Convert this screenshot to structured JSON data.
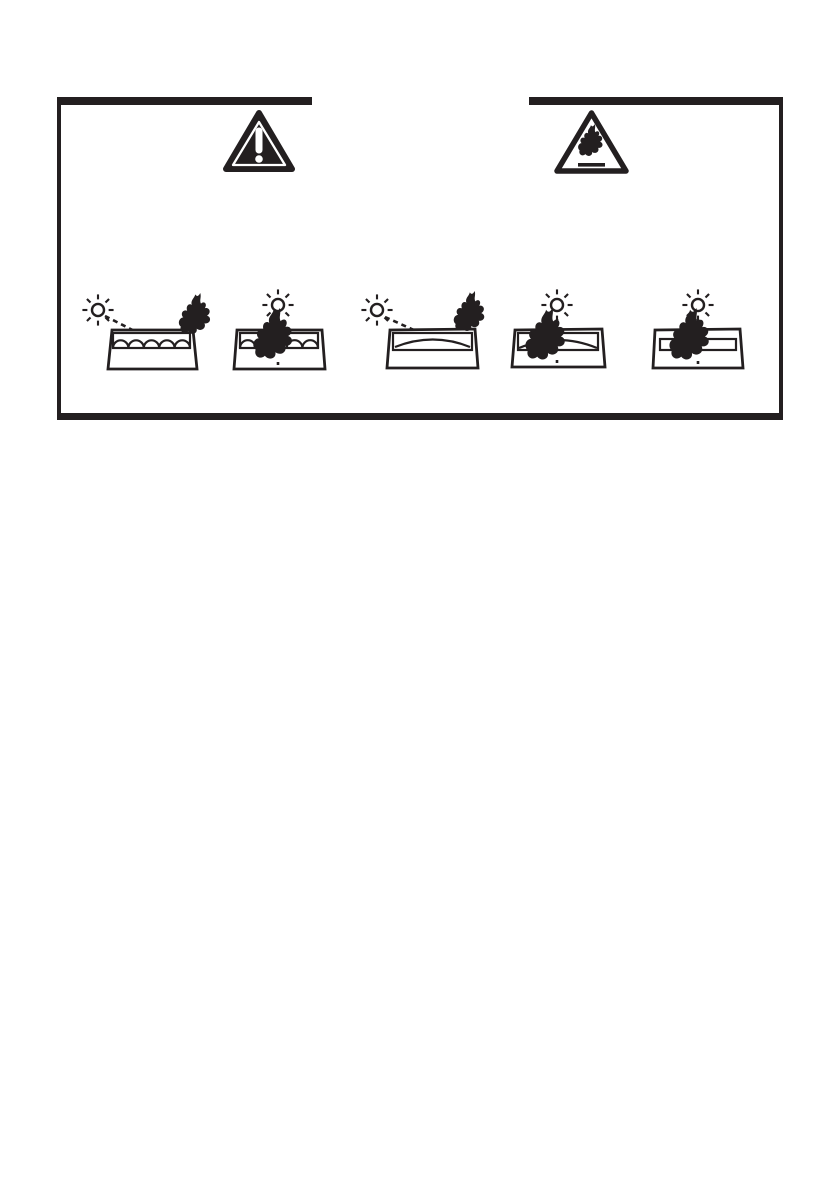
{
  "colors": {
    "background": "#ffffff",
    "ink": "#231f20",
    "symbol_white": "#ffffff"
  },
  "warning_box": {
    "header_icons": {
      "left": {
        "name": "warning-triangle-exclamation-icon",
        "title": "General hazard warning triangle"
      },
      "right": {
        "name": "warning-triangle-flammable-icon",
        "title": "Flammable hazard warning triangle"
      }
    },
    "pictograms": [
      {
        "title": "Slanted sun ray onto tray of curved objects ignites fire beside the tray"
      },
      {
        "title": "Overhead sun ray onto tray of curved objects ignites fire inside the tray"
      },
      {
        "title": "Slanted sun ray reflected by curved glass ignites fire at the tray edge"
      },
      {
        "title": "Overhead sun ray through curved glass ignites fire inside the tray"
      },
      {
        "title": "Overhead sun ray through flat glass ignites fire inside the tray"
      }
    ]
  }
}
